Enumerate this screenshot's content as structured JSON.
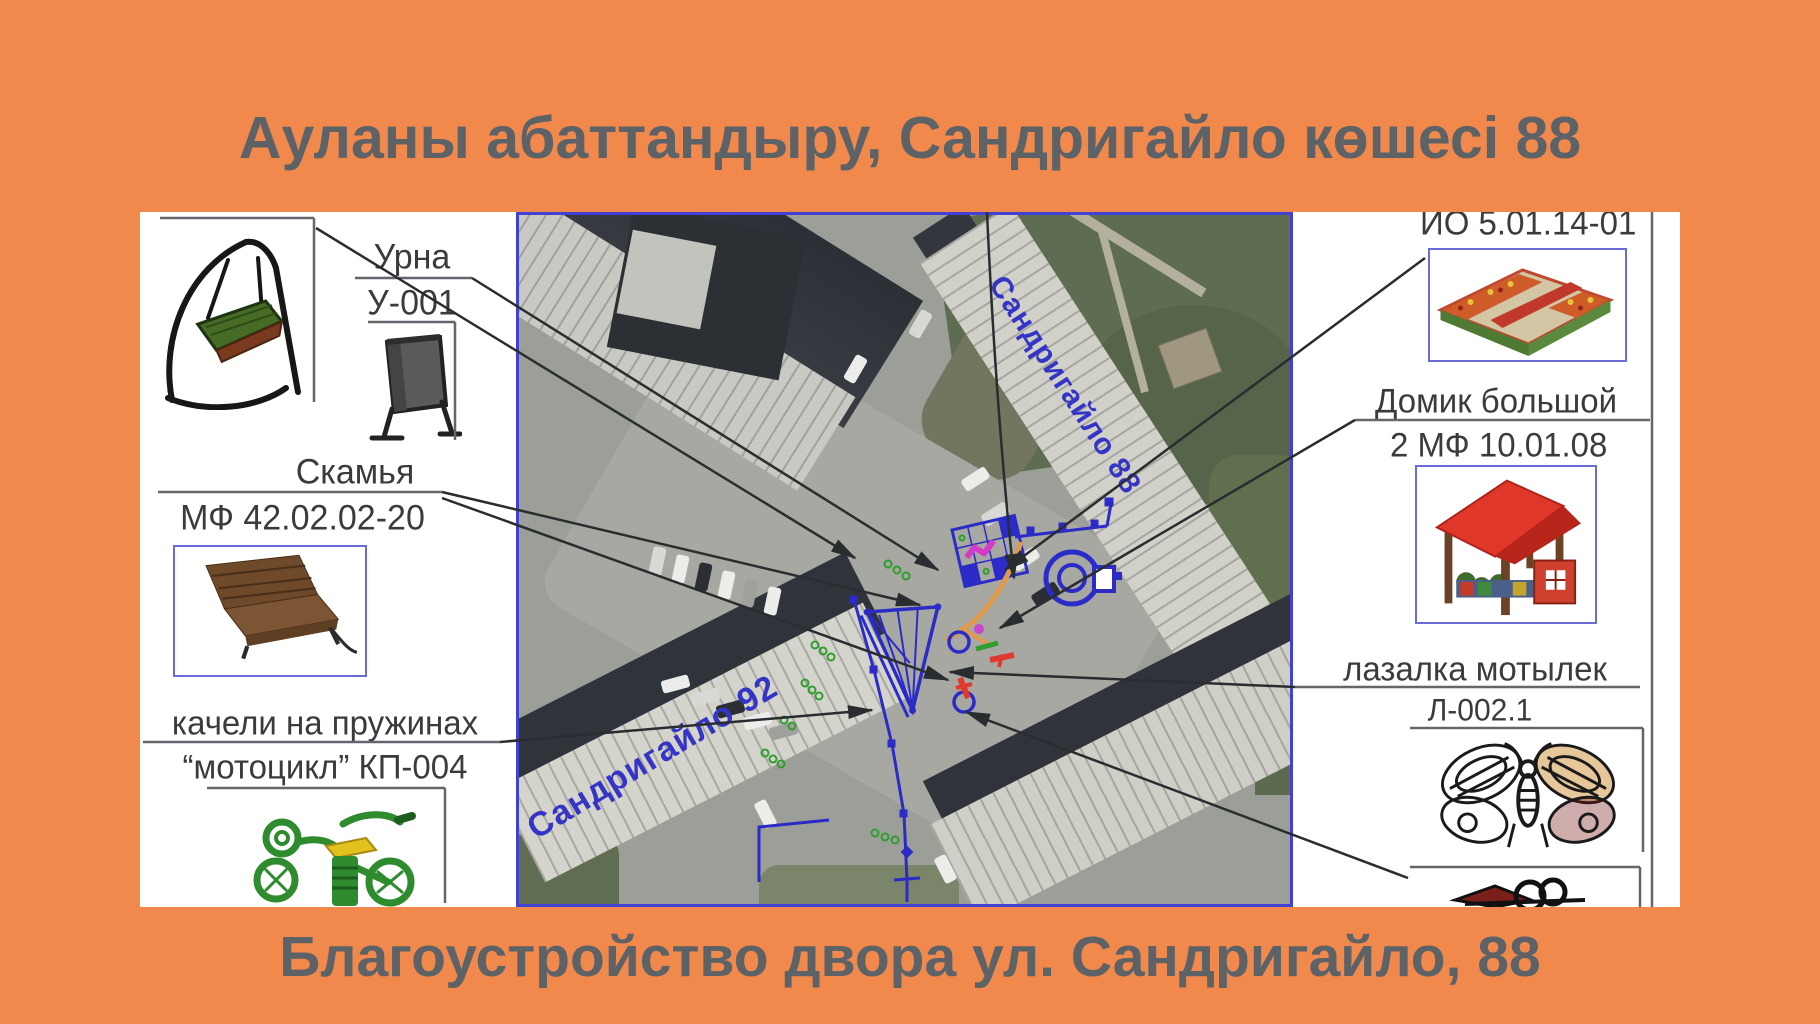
{
  "titles": {
    "top": "Ауланы абаттандыру, Сандригайло көшесі 88",
    "bottom": "Благоустройство двора ул. Сандригайло, 88"
  },
  "map": {
    "street_labels": [
      {
        "text": "Сандригайло 88"
      },
      {
        "text": "Сандригайло 92"
      }
    ]
  },
  "legend_left": {
    "urn": {
      "line1": "Урна",
      "line2": "У-001"
    },
    "bench": {
      "line1": "Скамья",
      "line2": "МФ 42.02.02-20"
    },
    "rocker": {
      "line1": "качели на пружинах",
      "line2": "“мотоцикл” КП-004"
    }
  },
  "legend_right": {
    "sandbox": {
      "line1": "ИО 5.01.14-01"
    },
    "house": {
      "line1": "Домик большой",
      "line2": "2 МФ 10.01.08"
    },
    "butterfly": {
      "line1": "лазалка мотылек",
      "line2": "Л-002.1"
    }
  },
  "icons": {
    "swing": "swing-drawing",
    "urn": "urn-drawing",
    "bench": "bench-photo",
    "rocker": "motorcycle-spring-rocker-photo",
    "sandbox": "sandbox-photo",
    "house": "playhouse-photo",
    "butterfly": "butterfly-climber-drawing",
    "partial": "equipment-partial-drawing"
  },
  "colors": {
    "background": "#F1894C",
    "title_text": "#5D6267",
    "panel_text": "#3B3B3B",
    "cad_blue": "#2B2BC8",
    "map_border": "#4242D2",
    "image_box_border": "#6B6BD6",
    "callout_line": "#3F4245",
    "path_orange": "#E09A4A",
    "mark_red": "#E0392E",
    "mark_green": "#2F9E2F",
    "mark_magenta": "#CC44CC",
    "street_label_blue": "#3434C6"
  }
}
